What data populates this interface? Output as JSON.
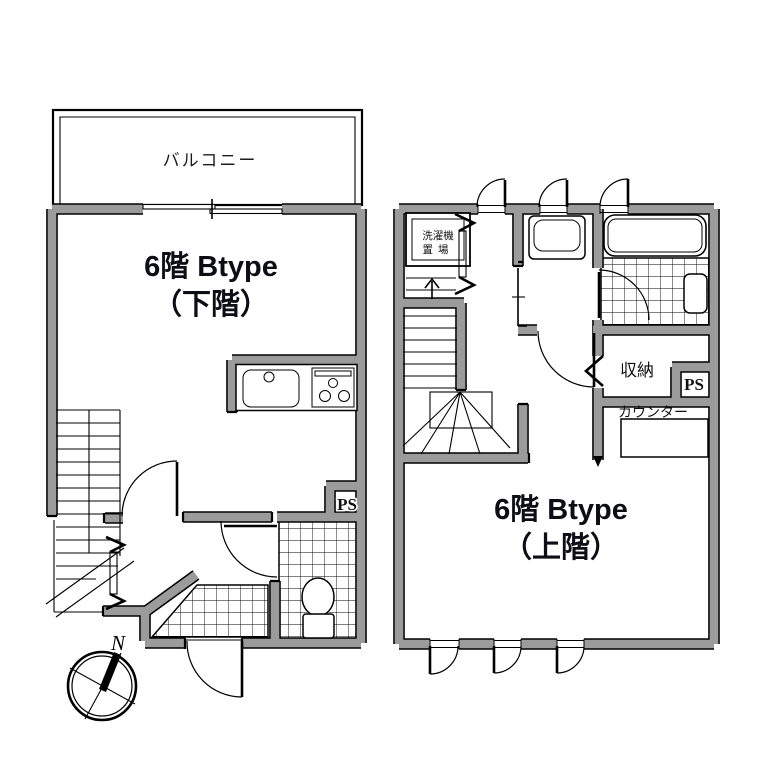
{
  "lower_floor": {
    "balcony_label": "バルコニー",
    "title_line1": "6階 Btype",
    "title_line2": "（下階）",
    "pipe_space_label": "PS"
  },
  "upper_floor": {
    "title_line1": "6階 Btype",
    "title_line2": "（上階）",
    "washer_label_line1": "洗濯機",
    "washer_label_line2": "置場",
    "storage_label": "収納",
    "counter_label": "カウンター",
    "pipe_space_label": "PS"
  },
  "compass": {
    "north_label": "N"
  },
  "colors": {
    "wall_fill": "#9b9b9b",
    "wall_edge": "#000000",
    "background": "#ffffff",
    "text": "#0d0d15"
  }
}
